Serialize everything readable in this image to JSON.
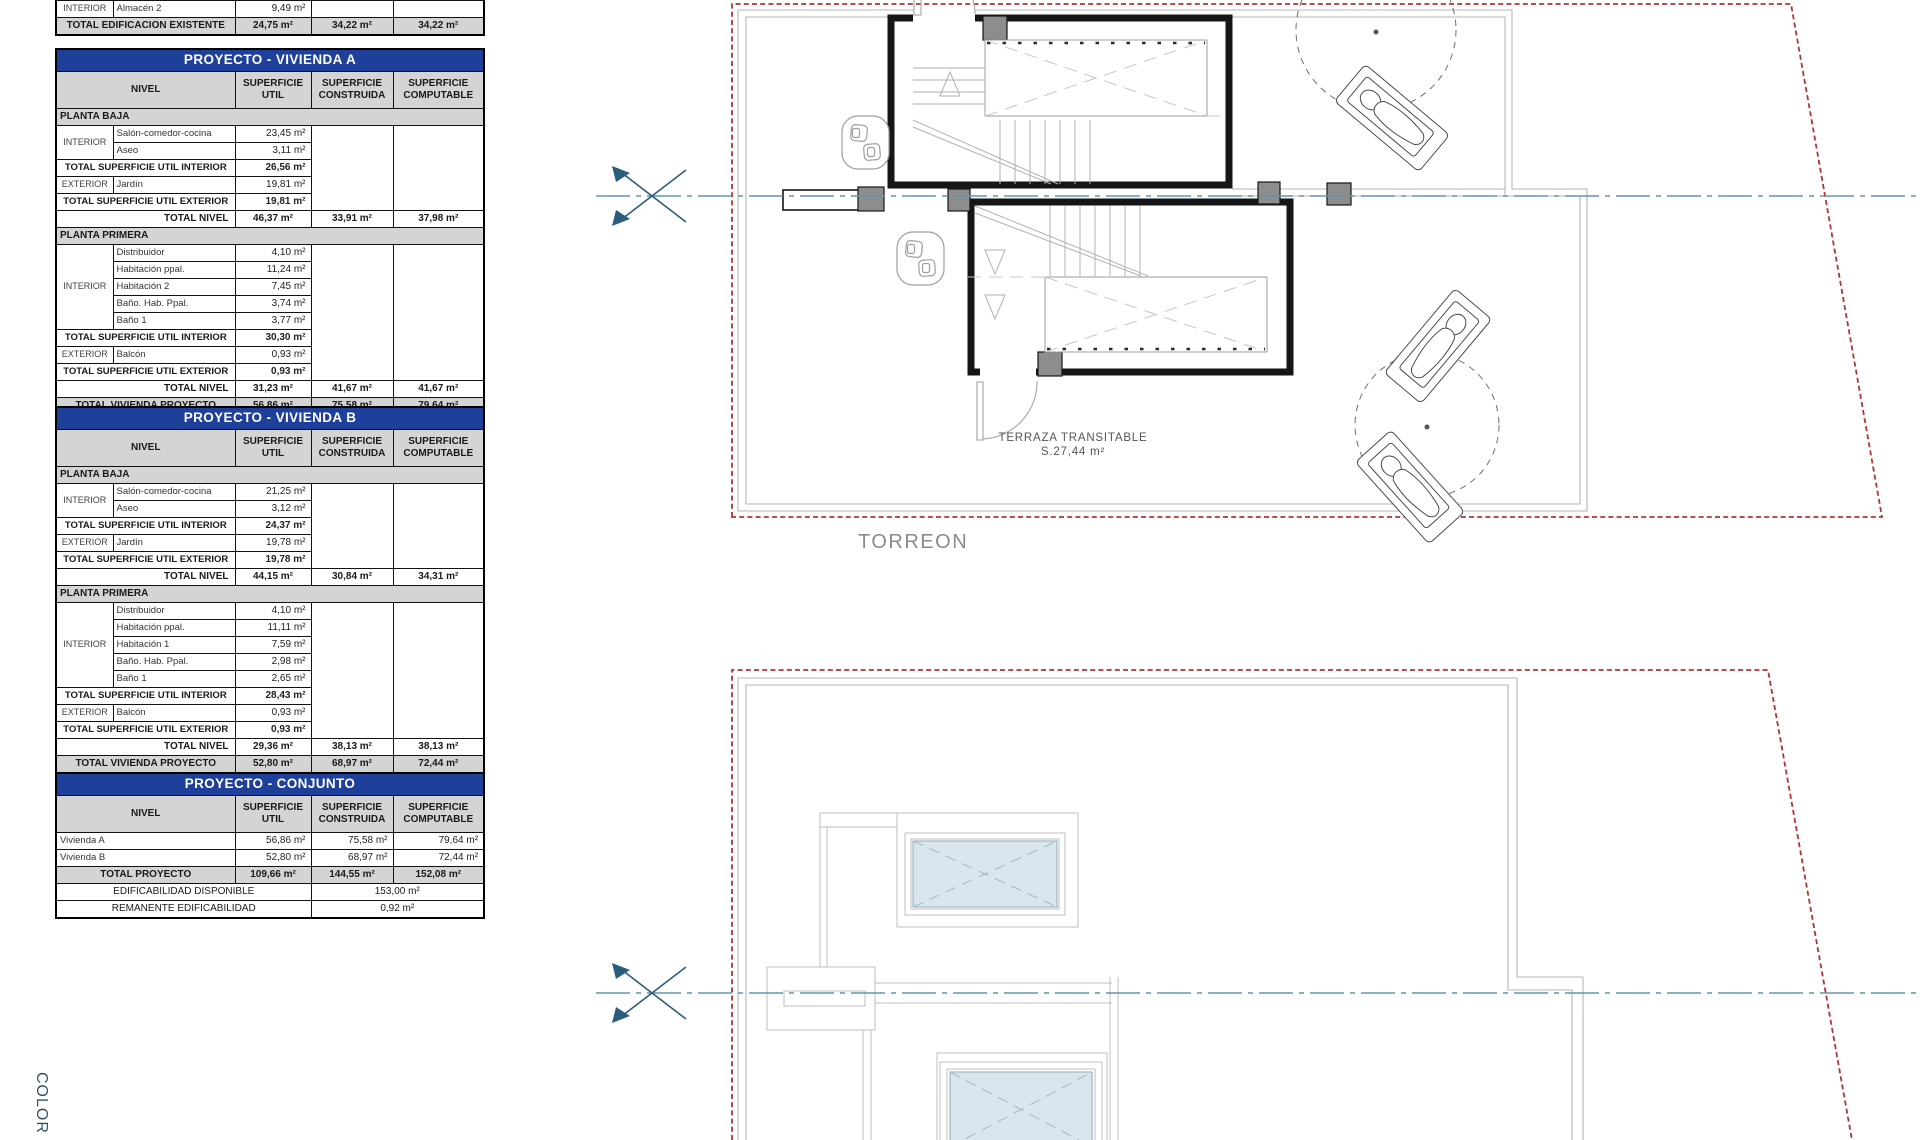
{
  "colors": {
    "title_blue": "#1e3f9a",
    "header_gray": "#d4d4d4",
    "boundary_red": "#b13434",
    "centerline_teal": "#6496a6",
    "marker_navy": "#2b5d7c",
    "skylight_blue": "#d9e6ed"
  },
  "plan_top": {
    "torreon_label": "TORREON",
    "terrace_label_line1": "TERRAZA TRANSITABLE",
    "terrace_label_line2": "S.27,44 m²"
  },
  "margin_label": "COLOR",
  "tables": {
    "existing": {
      "name": "table-edificacion-existente",
      "x": 55,
      "y": 0,
      "w": 428,
      "cols": [
        57,
        122,
        76,
        82,
        91
      ],
      "rows": [
        {
          "c": [
            {
              "t": "INTERIOR",
              "k": "grp"
            },
            {
              "t": "Almacén 2",
              "k": "nm"
            },
            {
              "t": "9,49 m²",
              "k": "val"
            },
            {
              "t": "",
              "k": "blank"
            },
            {
              "t": "",
              "k": "blank"
            }
          ]
        },
        {
          "k": "grand",
          "c": [
            {
              "t": "TOTAL EDIFICACION EXISTENTE",
              "cs": 2,
              "k": "ctr"
            },
            {
              "t": "24,75 m²",
              "k": "ctr"
            },
            {
              "t": "34,22 m²",
              "k": "ctr"
            },
            {
              "t": "34,22 m²",
              "k": "ctr"
            }
          ]
        }
      ]
    },
    "vivienda_a": {
      "name": "table-proyecto-vivienda-a",
      "x": 55,
      "y": 48,
      "w": 428,
      "cols": [
        57,
        122,
        76,
        82,
        91
      ],
      "rows": [
        {
          "k": "title",
          "c": [
            {
              "t": "PROYECTO - VIVIENDA A",
              "cs": 5
            }
          ]
        },
        {
          "k": "hdr",
          "c": [
            {
              "t": "NIVEL",
              "cs": 2
            },
            {
              "t": "SUPERFICIE UTIL"
            },
            {
              "t": "SUPERFICIE CONSTRUIDA"
            },
            {
              "t": "SUPERFICIE COMPUTABLE"
            }
          ]
        },
        {
          "k": "sec",
          "c": [
            {
              "t": "PLANTA BAJA",
              "cs": 5
            }
          ]
        },
        {
          "c": [
            {
              "t": "INTERIOR",
              "k": "grp",
              "rs": 2
            },
            {
              "t": "Salón-comedor-cocina",
              "k": "nm"
            },
            {
              "t": "23,45 m²",
              "k": "val"
            },
            {
              "t": "",
              "rs": 5,
              "k": "blank"
            },
            {
              "t": "",
              "rs": 5,
              "k": "blank"
            }
          ]
        },
        {
          "c": [
            {
              "t": "Aseo",
              "k": "nm"
            },
            {
              "t": "3,11 m²",
              "k": "val"
            }
          ]
        },
        {
          "c": [
            {
              "t": "TOTAL SUPERFICIE UTIL INTERIOR",
              "cs": 2,
              "k": "tl"
            },
            {
              "t": "26,56 m²",
              "k": "val b"
            }
          ]
        },
        {
          "c": [
            {
              "t": "EXTERIOR",
              "k": "grp"
            },
            {
              "t": "Jardín",
              "k": "nm"
            },
            {
              "t": "19,81 m²",
              "k": "val"
            }
          ]
        },
        {
          "c": [
            {
              "t": "TOTAL SUPERFICIE UTIL EXTERIOR",
              "cs": 2,
              "k": "tl"
            },
            {
              "t": "19,81 m²",
              "k": "val b"
            }
          ]
        },
        {
          "c": [
            {
              "t": "TOTAL NIVEL",
              "cs": 2,
              "k": "trr"
            },
            {
              "t": "46,37 m²",
              "k": "b ctr"
            },
            {
              "t": "33,91 m²",
              "k": "b ctr"
            },
            {
              "t": "37,98 m²",
              "k": "b ctr"
            }
          ]
        },
        {
          "k": "sec",
          "c": [
            {
              "t": "PLANTA PRIMERA",
              "cs": 5
            }
          ]
        },
        {
          "c": [
            {
              "t": "INTERIOR",
              "k": "grp",
              "rs": 5
            },
            {
              "t": "Distribuidor",
              "k": "nm"
            },
            {
              "t": "4,10 m²",
              "k": "val"
            },
            {
              "t": "",
              "rs": 8,
              "k": "blank"
            },
            {
              "t": "",
              "rs": 8,
              "k": "blank"
            }
          ]
        },
        {
          "c": [
            {
              "t": "Habitación ppal.",
              "k": "nm"
            },
            {
              "t": "11,24 m²",
              "k": "val"
            }
          ]
        },
        {
          "c": [
            {
              "t": "Habitación 2",
              "k": "nm"
            },
            {
              "t": "7,45 m²",
              "k": "val"
            }
          ]
        },
        {
          "c": [
            {
              "t": "Baño. Hab. Ppal.",
              "k": "nm"
            },
            {
              "t": "3,74 m²",
              "k": "val"
            }
          ]
        },
        {
          "c": [
            {
              "t": "Baño 1",
              "k": "nm"
            },
            {
              "t": "3,77 m²",
              "k": "val"
            }
          ]
        },
        {
          "c": [
            {
              "t": "TOTAL SUPERFICIE UTIL INTERIOR",
              "cs": 2,
              "k": "tl"
            },
            {
              "t": "30,30 m²",
              "k": "val b"
            }
          ]
        },
        {
          "c": [
            {
              "t": "EXTERIOR",
              "k": "grp"
            },
            {
              "t": "Balcón",
              "k": "nm"
            },
            {
              "t": "0,93 m²",
              "k": "val"
            }
          ]
        },
        {
          "c": [
            {
              "t": "TOTAL SUPERFICIE UTIL EXTERIOR",
              "cs": 2,
              "k": "tl"
            },
            {
              "t": "0,93 m²",
              "k": "val b"
            }
          ]
        },
        {
          "c": [
            {
              "t": "TOTAL NIVEL",
              "cs": 2,
              "k": "trr"
            },
            {
              "t": "31,23 m²",
              "k": "b ctr"
            },
            {
              "t": "41,67 m²",
              "k": "b ctr"
            },
            {
              "t": "41,67 m²",
              "k": "b ctr"
            }
          ]
        },
        {
          "k": "grand",
          "h": 17,
          "c": [
            {
              "t": "TOTAL VIVIENDA PROYECTO",
              "cs": 2,
              "k": "ctr"
            },
            {
              "t": "56,86 m²",
              "k": "ctr"
            },
            {
              "t": "75,58 m²",
              "k": "ctr"
            },
            {
              "t": "79,64 m²",
              "k": "ctr"
            }
          ]
        }
      ]
    },
    "vivienda_b": {
      "name": "table-proyecto-vivienda-b",
      "x": 55,
      "y": 406,
      "w": 428,
      "cols": [
        57,
        122,
        76,
        82,
        91
      ],
      "rows": [
        {
          "k": "title",
          "c": [
            {
              "t": "PROYECTO - VIVIENDA B",
              "cs": 5
            }
          ]
        },
        {
          "k": "hdr",
          "c": [
            {
              "t": "NIVEL",
              "cs": 2
            },
            {
              "t": "SUPERFICIE UTIL"
            },
            {
              "t": "SUPERFICIE CONSTRUIDA"
            },
            {
              "t": "SUPERFICIE COMPUTABLE"
            }
          ]
        },
        {
          "k": "sec",
          "c": [
            {
              "t": "PLANTA BAJA",
              "cs": 5
            }
          ]
        },
        {
          "c": [
            {
              "t": "INTERIOR",
              "k": "grp",
              "rs": 2
            },
            {
              "t": "Salón-comedor-cocina",
              "k": "nm"
            },
            {
              "t": "21,25 m²",
              "k": "val"
            },
            {
              "t": "",
              "rs": 5,
              "k": "blank"
            },
            {
              "t": "",
              "rs": 5,
              "k": "blank"
            }
          ]
        },
        {
          "c": [
            {
              "t": "Aseo",
              "k": "nm"
            },
            {
              "t": "3,12 m²",
              "k": "val"
            }
          ]
        },
        {
          "c": [
            {
              "t": "TOTAL SUPERFICIE UTIL INTERIOR",
              "cs": 2,
              "k": "tl"
            },
            {
              "t": "24,37 m²",
              "k": "val b"
            }
          ]
        },
        {
          "c": [
            {
              "t": "EXTERIOR",
              "k": "grp"
            },
            {
              "t": "Jardín",
              "k": "nm"
            },
            {
              "t": "19,78 m²",
              "k": "val"
            }
          ]
        },
        {
          "c": [
            {
              "t": "TOTAL SUPERFICIE UTIL EXTERIOR",
              "cs": 2,
              "k": "tl"
            },
            {
              "t": "19,78 m²",
              "k": "val b"
            }
          ]
        },
        {
          "c": [
            {
              "t": "TOTAL NIVEL",
              "cs": 2,
              "k": "trr"
            },
            {
              "t": "44,15 m²",
              "k": "b ctr"
            },
            {
              "t": "30,84 m²",
              "k": "b ctr"
            },
            {
              "t": "34,31 m²",
              "k": "b ctr"
            }
          ]
        },
        {
          "k": "sec",
          "c": [
            {
              "t": "PLANTA PRIMERA",
              "cs": 5
            }
          ]
        },
        {
          "c": [
            {
              "t": "INTERIOR",
              "k": "grp",
              "rs": 5
            },
            {
              "t": "Distribuidor",
              "k": "nm"
            },
            {
              "t": "4,10 m²",
              "k": "val"
            },
            {
              "t": "",
              "rs": 8,
              "k": "blank"
            },
            {
              "t": "",
              "rs": 8,
              "k": "blank"
            }
          ]
        },
        {
          "c": [
            {
              "t": "Habitación ppal.",
              "k": "nm"
            },
            {
              "t": "11,11 m²",
              "k": "val"
            }
          ]
        },
        {
          "c": [
            {
              "t": "Habitación 1",
              "k": "nm"
            },
            {
              "t": "7,59 m²",
              "k": "val"
            }
          ]
        },
        {
          "c": [
            {
              "t": "Baño. Hab. Ppal.",
              "k": "nm"
            },
            {
              "t": "2,98 m²",
              "k": "val"
            }
          ]
        },
        {
          "c": [
            {
              "t": "Baño 1",
              "k": "nm"
            },
            {
              "t": "2,65 m²",
              "k": "val"
            }
          ]
        },
        {
          "c": [
            {
              "t": "TOTAL SUPERFICIE UTIL INTERIOR",
              "cs": 2,
              "k": "tl"
            },
            {
              "t": "28,43 m²",
              "k": "val b"
            }
          ]
        },
        {
          "c": [
            {
              "t": "EXTERIOR",
              "k": "grp"
            },
            {
              "t": "Balcón",
              "k": "nm"
            },
            {
              "t": "0,93 m²",
              "k": "val"
            }
          ]
        },
        {
          "c": [
            {
              "t": "TOTAL SUPERFICIE UTIL EXTERIOR",
              "cs": 2,
              "k": "tl"
            },
            {
              "t": "0,93 m²",
              "k": "val b"
            }
          ]
        },
        {
          "c": [
            {
              "t": "TOTAL NIVEL",
              "cs": 2,
              "k": "trr"
            },
            {
              "t": "29,36 m²",
              "k": "b ctr"
            },
            {
              "t": "38,13 m²",
              "k": "b ctr"
            },
            {
              "t": "38,13 m²",
              "k": "b ctr"
            }
          ]
        },
        {
          "k": "grand",
          "h": 17,
          "c": [
            {
              "t": "TOTAL VIVIENDA PROYECTO",
              "cs": 2,
              "k": "ctr"
            },
            {
              "t": "52,80 m²",
              "k": "ctr"
            },
            {
              "t": "68,97 m²",
              "k": "ctr"
            },
            {
              "t": "72,44 m²",
              "k": "ctr"
            }
          ]
        }
      ]
    },
    "conjunto": {
      "name": "table-proyecto-conjunto",
      "x": 55,
      "y": 772,
      "w": 428,
      "cols": [
        57,
        122,
        76,
        82,
        91
      ],
      "rows": [
        {
          "k": "title",
          "c": [
            {
              "t": "PROYECTO - CONJUNTO",
              "cs": 5
            }
          ]
        },
        {
          "k": "hdr",
          "c": [
            {
              "t": "NIVEL",
              "cs": 2
            },
            {
              "t": "SUPERFICIE UTIL"
            },
            {
              "t": "SUPERFICIE CONSTRUIDA"
            },
            {
              "t": "SUPERFICIE COMPUTABLE"
            }
          ]
        },
        {
          "c": [
            {
              "t": "Vivienda A",
              "cs": 2,
              "k": "nm"
            },
            {
              "t": "56,86 m²",
              "k": "val"
            },
            {
              "t": "75,58 m²",
              "k": "val"
            },
            {
              "t": "79,64 m²",
              "k": "val"
            }
          ]
        },
        {
          "c": [
            {
              "t": "Vivienda B",
              "cs": 2,
              "k": "nm"
            },
            {
              "t": "52,80 m²",
              "k": "val"
            },
            {
              "t": "68,97 m²",
              "k": "val"
            },
            {
              "t": "72,44 m²",
              "k": "val"
            }
          ]
        },
        {
          "k": "grand",
          "h": 17,
          "c": [
            {
              "t": "TOTAL PROYECTO",
              "cs": 2,
              "k": "ctr"
            },
            {
              "t": "109,66 m²",
              "k": "ctr"
            },
            {
              "t": "144,55 m²",
              "k": "ctr"
            },
            {
              "t": "152,08 m²",
              "k": "ctr"
            }
          ]
        },
        {
          "c": [
            {
              "t": "EDIFICABILIDAD DISPONIBLE",
              "cs": 3,
              "k": "ctr"
            },
            {
              "t": "153,00 m²",
              "cs": 2,
              "k": "ctr"
            }
          ]
        },
        {
          "c": [
            {
              "t": "REMANENTE EDIFICABILIDAD",
              "cs": 3,
              "k": "ctr"
            },
            {
              "t": "0,92 m²",
              "cs": 2,
              "k": "ctr"
            }
          ]
        }
      ]
    }
  }
}
